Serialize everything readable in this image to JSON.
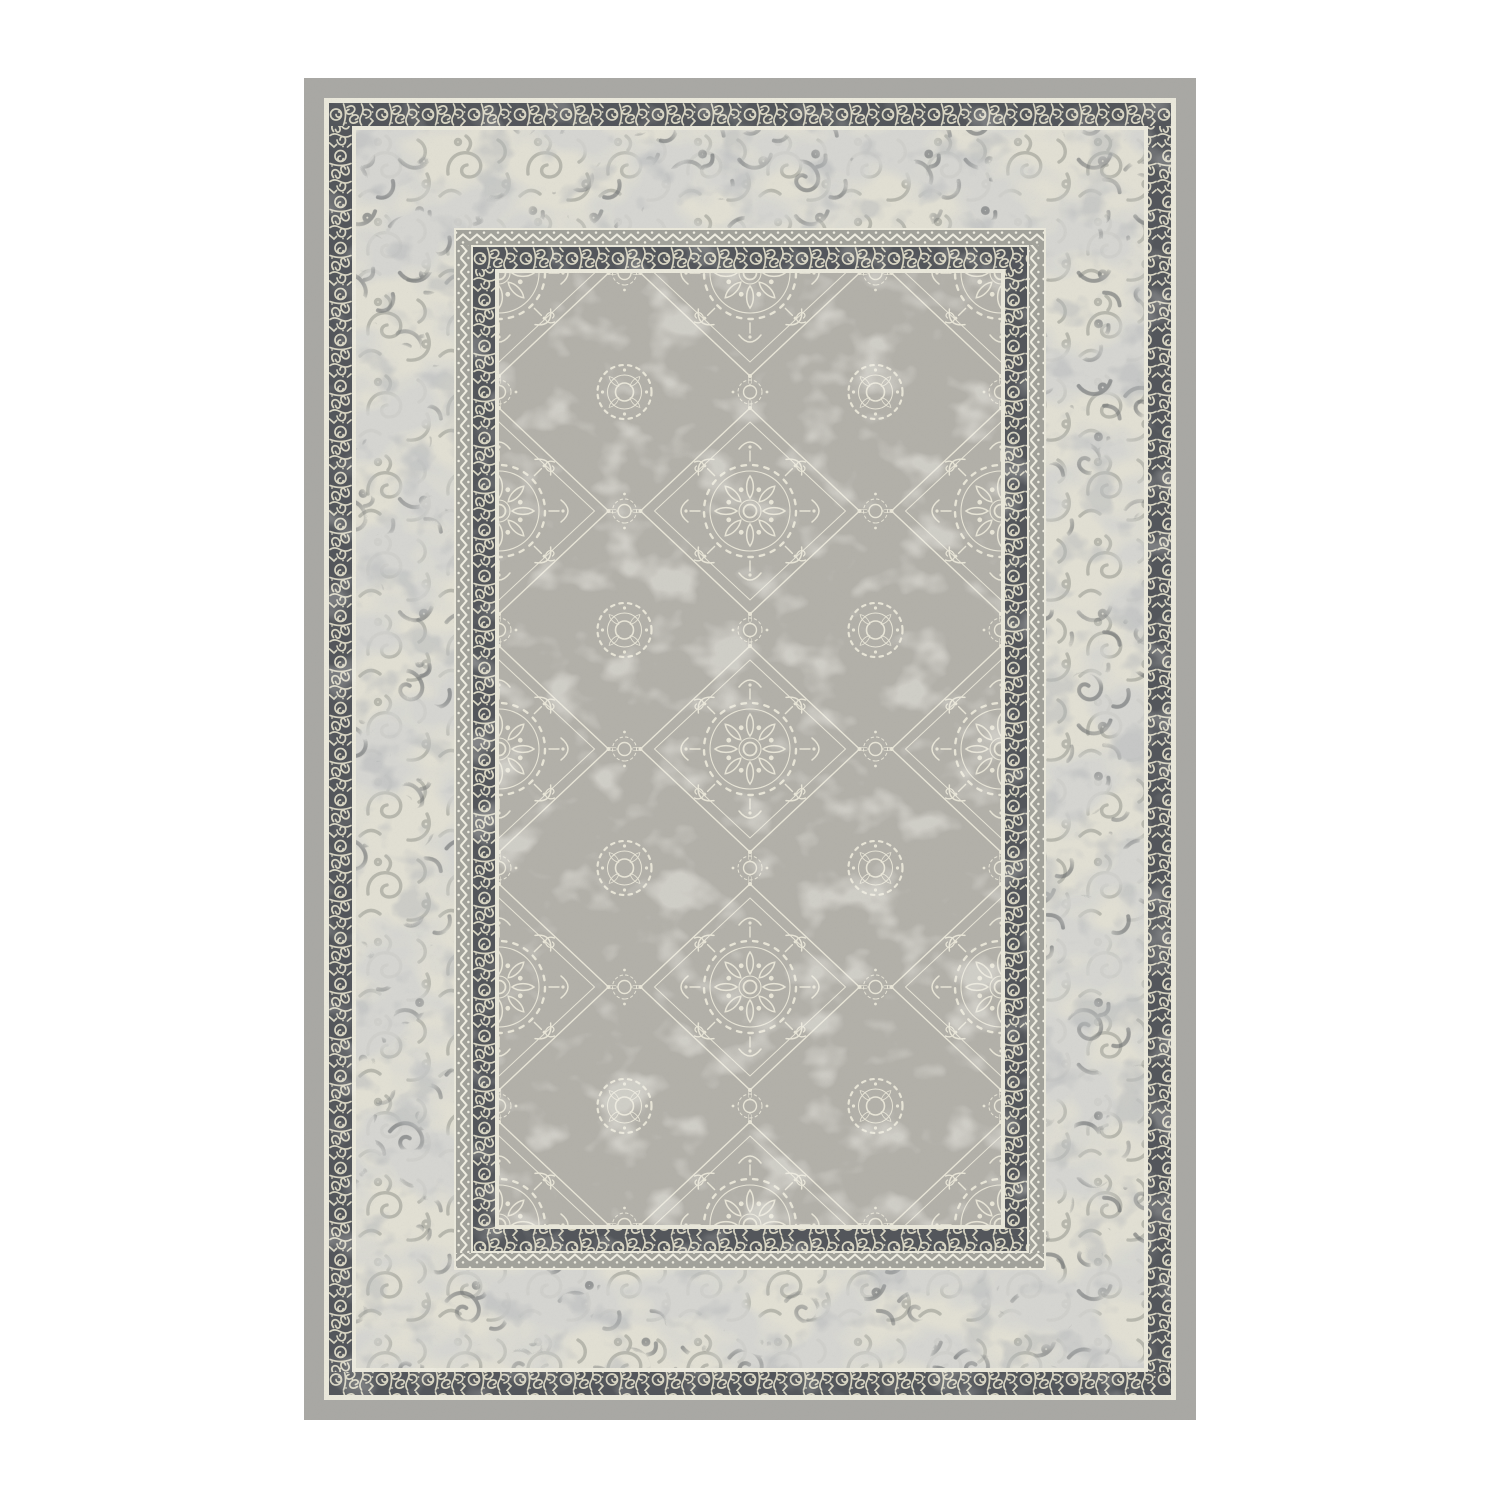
{
  "image": {
    "kind": "product-photo",
    "subject": "rectangular ornamental area rug, vintage oriental style, grey and cream",
    "orientation": "portrait",
    "text_content": "none"
  },
  "palette": {
    "page-bg": "#ffffff",
    "rug-cream": "#e9e7da",
    "frame-grey": "#a9a8a4",
    "border-dark": "#53565b",
    "border-pattern-cream": "#d8d5c3",
    "marble-base": "#e1dfd3",
    "marble-mottle": "#a7a8a2",
    "marble-shadow": "#7b7e80",
    "ghost-curl": "#94968d",
    "ghost-curl-dark": "#6a6d6f",
    "zigzag-band": "#a2a29b",
    "zigzag-line": "#efede1",
    "field-grey": "#b2b0a9",
    "field-line": "#e8e5d7",
    "wear-cream": "#e7e4d7",
    "grain": "#383836"
  },
  "rug": {
    "left": 304,
    "top": 78,
    "width": 892,
    "height": 1342,
    "bands_outer_to_inner": [
      {
        "name": "outer-solid-frame",
        "thickness": 20,
        "style": "plain grey"
      },
      {
        "name": "cream-gap",
        "thickness": 5
      },
      {
        "name": "outer-ornate-border",
        "thickness": 23,
        "style": "dark slate with cream scrollwork"
      },
      {
        "name": "cream-gap",
        "thickness": 4
      },
      {
        "name": "marbled-band",
        "thickness": 98,
        "style": "cream with grey mottling and faded curl ornament"
      },
      {
        "name": "zigzag-band",
        "thickness": 15,
        "style": "grey with cream chevron line and dots"
      },
      {
        "name": "inner-ornate-border",
        "thickness": 22,
        "style": "dark slate with cream scrollwork"
      },
      {
        "name": "cream-line",
        "thickness": 4
      },
      {
        "name": "field",
        "width": 502,
        "height": 952,
        "style": "grey ground with dense cream arabesque medallions"
      }
    ]
  }
}
